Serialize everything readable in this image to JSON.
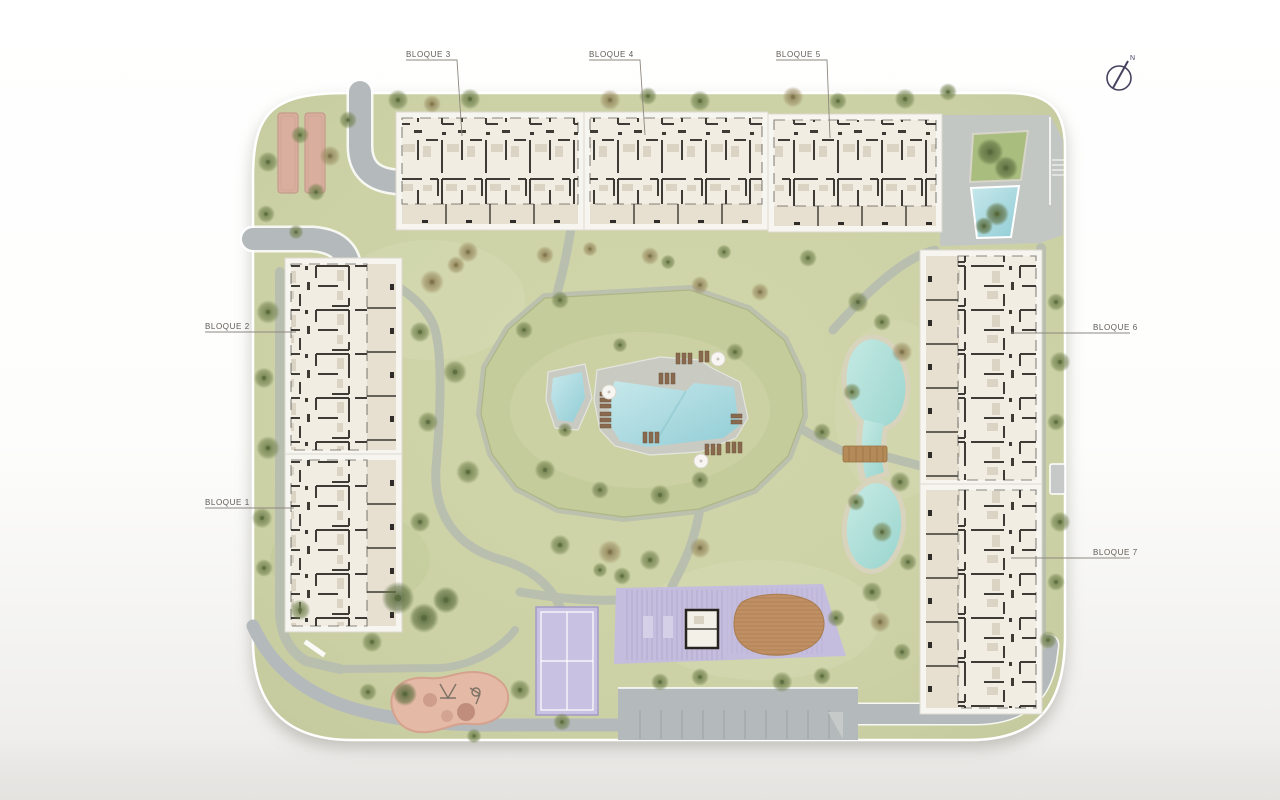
{
  "labels": [
    {
      "id": "bloque-1",
      "text": "BLOQUE 1"
    },
    {
      "id": "bloque-2",
      "text": "BLOQUE 2"
    },
    {
      "id": "bloque-3",
      "text": "BLOQUE 3"
    },
    {
      "id": "bloque-4",
      "text": "BLOQUE 4"
    },
    {
      "id": "bloque-5",
      "text": "BLOQUE 5"
    },
    {
      "id": "bloque-6",
      "text": "BLOQUE 6"
    },
    {
      "id": "bloque-7",
      "text": "BLOQUE 7"
    }
  ],
  "compass": {
    "label": "N"
  },
  "features": [
    "main-pool",
    "kids-pool",
    "pool-deck",
    "sun-loungers",
    "parasols",
    "lake",
    "lake-bridge",
    "padel-court",
    "sports-deck-zone",
    "wooden-deck",
    "playground",
    "parking-lot",
    "petanque-courts",
    "entrance-plaza",
    "planted-bed",
    "water-feature",
    "north-compass"
  ],
  "colors": {
    "lawn": "#cbd1a5",
    "lawn_light": "#d8dcb6",
    "lawn_dark": "#b3bd8a",
    "mound": "#c5cc9b",
    "road": "#b4babc",
    "path": "#b9bfae",
    "plaza": "#c3c7c3",
    "pool_water": "#a9dbe0",
    "lake_rim": "#d8d3bd",
    "deck": "#c9cbc3",
    "building": "#f1ede3",
    "building_pad": "#f7f5f0",
    "terrace": "#e7e0d1",
    "wall": "#2e2c28",
    "court": "#c9c1e1",
    "court_zone": "#c5bddd",
    "wood_deck": "#c09064",
    "bridge": "#b48a58",
    "playground": "#e4b9a6",
    "petanque": "#d9ae9e",
    "label_text": "#605b54",
    "leader_line": "#8d887f",
    "compass_ink": "#46425f"
  }
}
